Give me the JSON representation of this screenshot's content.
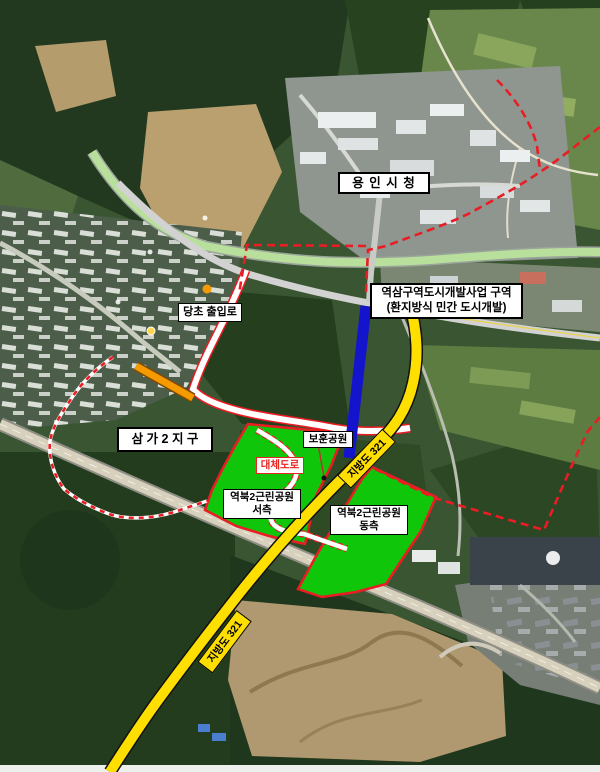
{
  "title": "역북2근린공원 / 역삼구역 도시개발사업 위치도 (항공사진)",
  "labels": {
    "city_hall": "용 인 시 청",
    "dev_zone_line1": "역삼구역도시개발사업 구역",
    "dev_zone_line2": "(환지방식 민간 도시개발)",
    "original_access_road": "당초 출입로",
    "samga2_district": "삼 가 2 지 구",
    "bohun_park": "보훈공원",
    "alternative_road": "대체도로",
    "park_name": "역북2근린공원",
    "west_side": "서측",
    "east_side": "동측",
    "provincial_road_321": "지방도 321"
  },
  "colors": {
    "boundary-red": "#ea1c24",
    "park-green": "#10c60a",
    "road-yellow": "#ffdf00",
    "road-blue": "#1414cc",
    "road-orange": "#f59a00",
    "alt-road-red": "#e8251f",
    "label-border": "#000000",
    "label-bg": "#ffffff"
  }
}
